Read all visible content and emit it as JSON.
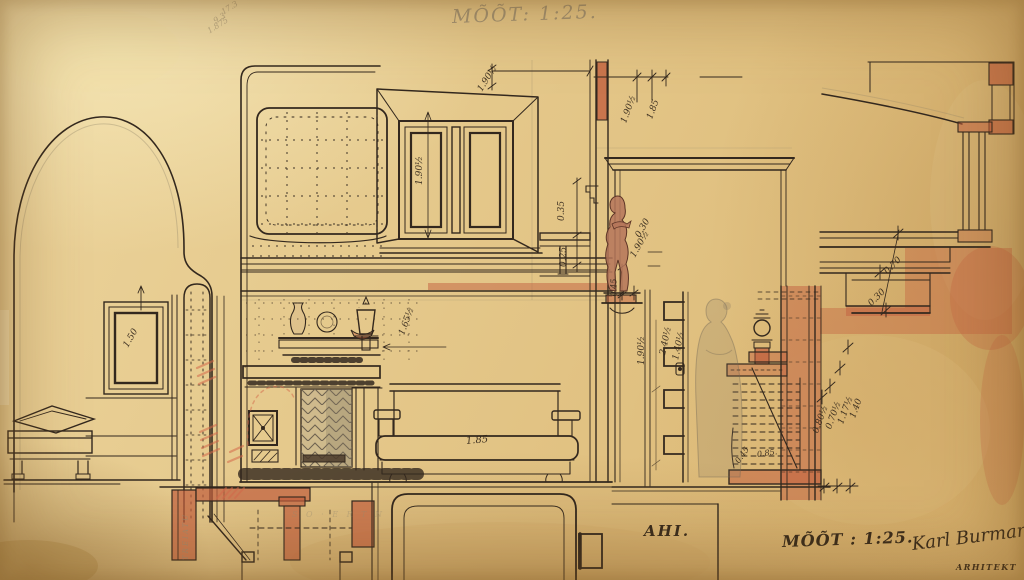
{
  "annotations": {
    "pencil_scale_note": "MÕÕT: 1:25.",
    "pencil_calc_line1": "17.3",
    "pencil_calc_line2": "9.3",
    "pencil_calc_line3": "1.875",
    "stove_label": "AHI.",
    "scale_label": "MÕÕT : 1:25.",
    "signature": "Karl Burman",
    "signature_role": "ARHITEKT",
    "plan_note_vertical": "TREIATU",
    "plan_note_faint": "S O · E R T N"
  },
  "dims": [
    "1.90½",
    "1.90½",
    "1.90½",
    "1.85",
    "0.35",
    "0.25",
    "0.30",
    "1.90½",
    "1.65½",
    "1.50",
    "1.85",
    "0.45",
    "1.90½",
    "2.40½",
    "1.40½",
    "0.45",
    "0.85.",
    "0.70",
    "0.30",
    "0.80½",
    "0.70½",
    "1.17½",
    "1.40"
  ],
  "colors": {
    "paper": "#e2c486",
    "ink": "#33281e",
    "section_red": "#c2603f",
    "red_pencil": "#d4694b",
    "pencil": "#978b72"
  }
}
